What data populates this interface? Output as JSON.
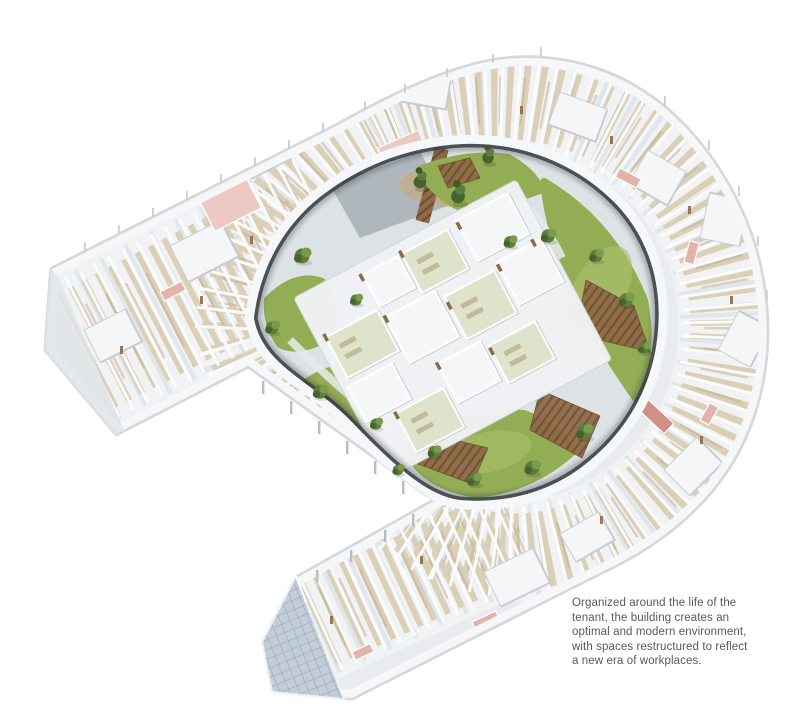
{
  "illustration": {
    "description": "Isometric cut-away rendering of a curved horseshoe-shaped office floor plate with two straight wings, enclosing a landscaped courtyard with lawns, trees, timber decks and a central cluster of glass-roofed pavilion rooms.",
    "palette": {
      "floor": "#e9ecee",
      "floor-tint": "#f0f2f4",
      "aisle": "#dce4ea",
      "rim": "#f6f7f9",
      "edge": "#c9cdd1",
      "bevel": "#d4d8db",
      "wall-shadow": "#c6cbd0",
      "desk": "#d7caac",
      "desk-dark": "#bfae8c",
      "partition": "#fbfcfe",
      "pink": "#e3b3aa",
      "pink-dark": "#d09087",
      "pink-light": "#ecc9c3",
      "grass": "#93ad55",
      "grass-light": "#a9bf6c",
      "tree": "#5d7d3c",
      "tree-light": "#7a9a4e",
      "tree-dark": "#46622e",
      "wood": "#8f6a47",
      "wood-dark": "#6f4f33",
      "amber": "#d3a660",
      "glass": "#c2cdd7",
      "glass-line": "#93a3b1",
      "shadow": "#3a3f44",
      "courtyard": "#dde2e5",
      "pavilion-glass": "#dde4cb",
      "pavilion-white": "#f5f6f7",
      "caption-text": "#58595b"
    }
  },
  "caption": {
    "lines": [
      "Organized around the life of the",
      "tenant, the building creates an",
      "optimal and modern environment,",
      "with spaces restructured to reflect",
      "a new era of workplaces."
    ]
  }
}
